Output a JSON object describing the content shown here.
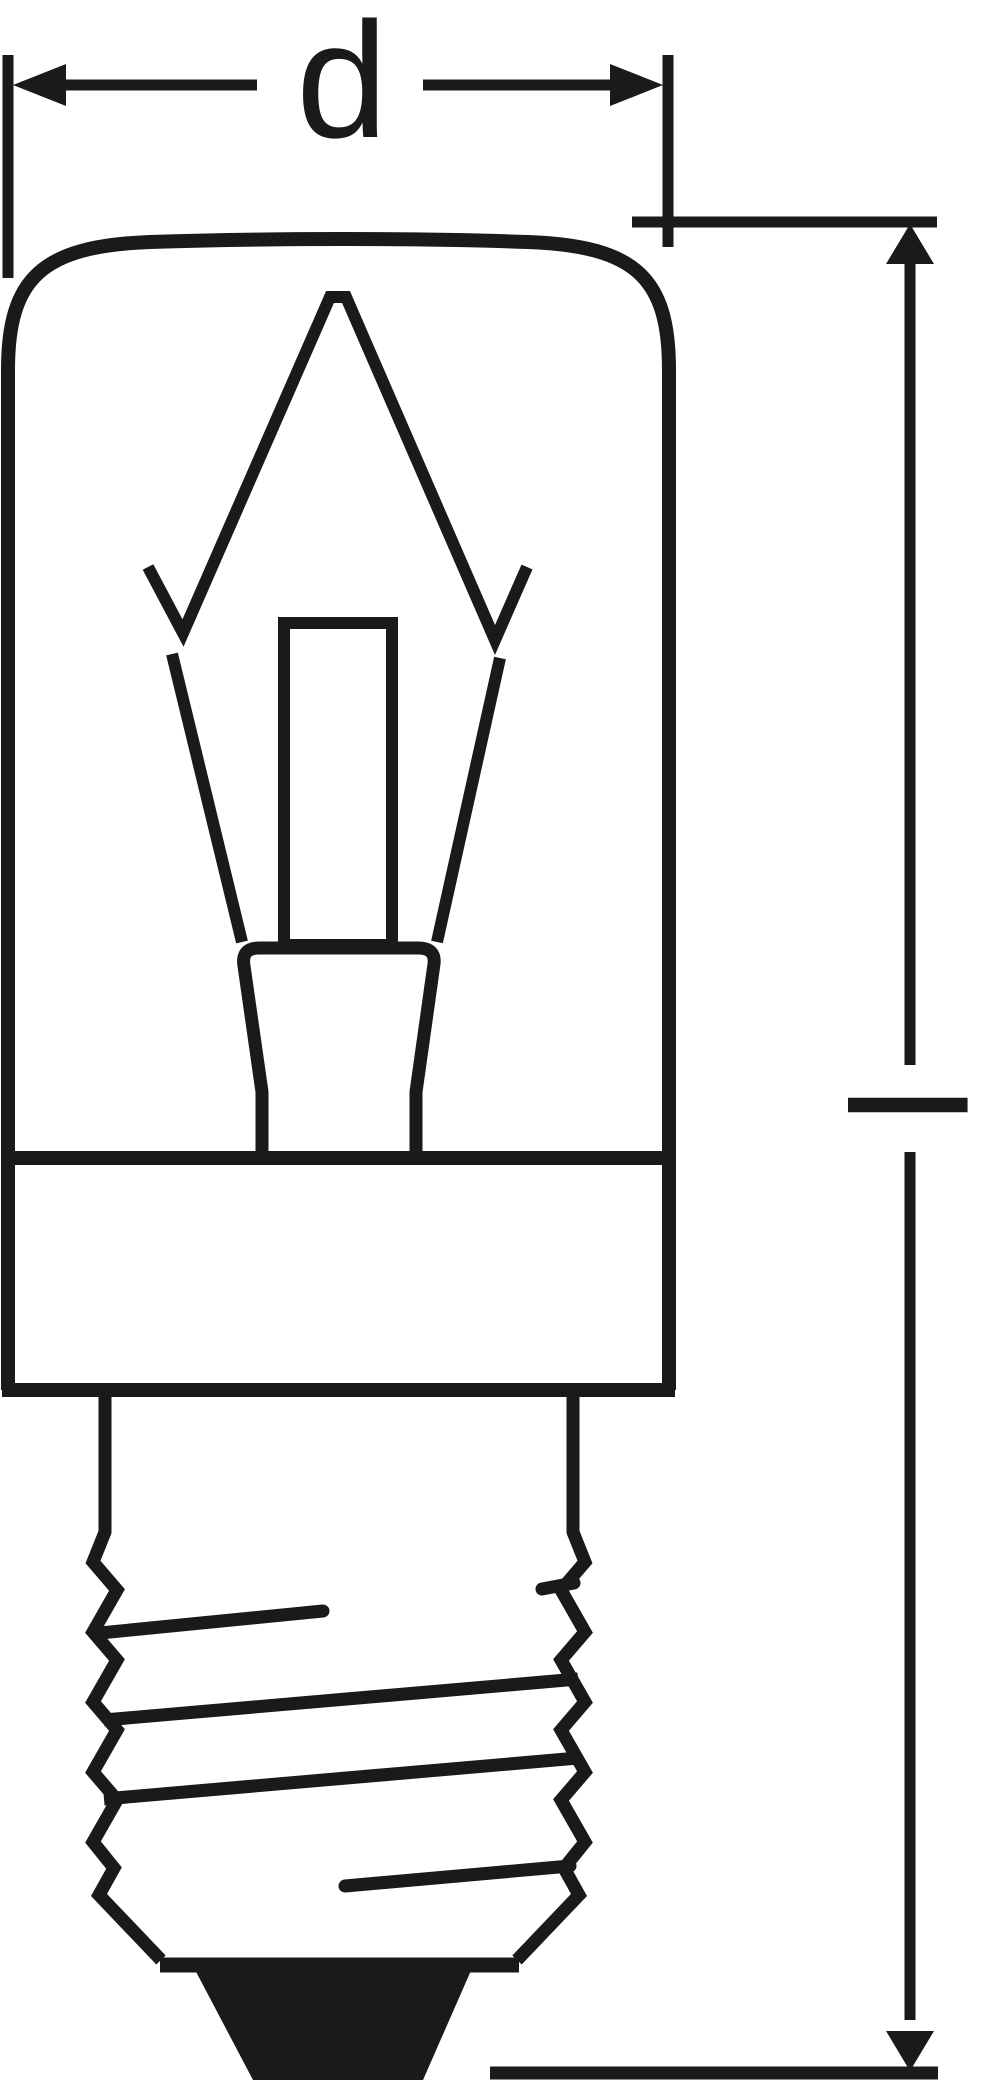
{
  "drawing": {
    "title": "Incandescent tube lamp with E14 screw base — outline dimension drawing",
    "type": "technical-line-drawing",
    "labels": {
      "diameter": "d",
      "length": "l"
    },
    "parts": [
      "diameter dimension with arrows",
      "tubular glass bulb",
      "filament wire",
      "support wires",
      "glass stem tube",
      "stem press",
      "base skirt",
      "E14 screw thread base",
      "solder contact tip",
      "length dimension with arrows"
    ],
    "colors": {
      "ink": "#1a1a1a",
      "background": "#ffffff"
    }
  }
}
